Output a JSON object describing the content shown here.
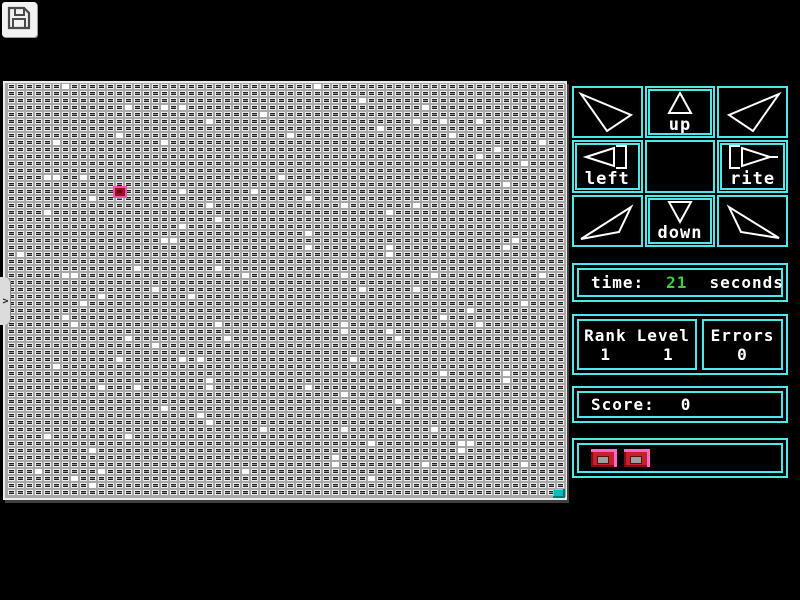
{
  "toolbar": {
    "save_icon": "floppy-disk"
  },
  "sidebar_tab": {
    "chevron": ">"
  },
  "board": {
    "cols": 62,
    "rows": 59,
    "cell_w": 9,
    "cell_h": 7,
    "colors": {
      "background": "#a8a8a8",
      "cell_border": "#ededed",
      "cell_dark": "#1f1f1f",
      "cell_band": "#8f8f8f",
      "white_cell": "#ffffff",
      "player_red": "#9c1020",
      "player_pink": "#f24fa6",
      "goal_teal": "#00bcbc"
    },
    "player_cell": {
      "col": 12,
      "row": 15
    },
    "goal_cell": {
      "col": 61,
      "row": 58
    },
    "white_cells": [
      [
        6,
        0
      ],
      [
        13,
        3
      ],
      [
        17,
        3
      ],
      [
        19,
        3
      ],
      [
        28,
        4
      ],
      [
        22,
        5
      ],
      [
        12,
        7
      ],
      [
        17,
        8
      ],
      [
        5,
        8
      ],
      [
        4,
        13
      ],
      [
        5,
        13
      ],
      [
        8,
        13
      ],
      [
        30,
        13
      ],
      [
        19,
        15
      ],
      [
        27,
        15
      ],
      [
        9,
        16
      ],
      [
        4,
        18
      ],
      [
        22,
        17
      ],
      [
        23,
        19
      ],
      [
        19,
        20
      ],
      [
        17,
        22
      ],
      [
        18,
        22
      ],
      [
        1,
        24
      ],
      [
        14,
        26
      ],
      [
        6,
        27
      ],
      [
        7,
        27
      ],
      [
        23,
        26
      ],
      [
        26,
        27
      ],
      [
        16,
        29
      ],
      [
        34,
        0
      ],
      [
        39,
        2
      ],
      [
        46,
        3
      ],
      [
        45,
        5
      ],
      [
        48,
        5
      ],
      [
        52,
        5
      ],
      [
        41,
        6
      ],
      [
        31,
        7
      ],
      [
        49,
        7
      ],
      [
        59,
        8
      ],
      [
        54,
        9
      ],
      [
        52,
        10
      ],
      [
        57,
        11
      ],
      [
        55,
        14
      ],
      [
        33,
        16
      ],
      [
        37,
        17
      ],
      [
        45,
        17
      ],
      [
        42,
        18
      ],
      [
        33,
        21
      ],
      [
        56,
        22
      ],
      [
        33,
        23
      ],
      [
        42,
        23
      ],
      [
        42,
        24
      ],
      [
        55,
        23
      ],
      [
        37,
        27
      ],
      [
        47,
        27
      ],
      [
        59,
        27
      ],
      [
        39,
        29
      ],
      [
        45,
        29
      ],
      [
        8,
        31
      ],
      [
        10,
        30
      ],
      [
        20,
        30
      ],
      [
        6,
        33
      ],
      [
        7,
        34
      ],
      [
        23,
        34
      ],
      [
        13,
        36
      ],
      [
        24,
        36
      ],
      [
        16,
        37
      ],
      [
        12,
        39
      ],
      [
        19,
        39
      ],
      [
        21,
        39
      ],
      [
        5,
        40
      ],
      [
        22,
        42
      ],
      [
        10,
        43
      ],
      [
        14,
        43
      ],
      [
        22,
        43
      ],
      [
        17,
        46
      ],
      [
        21,
        47
      ],
      [
        22,
        48
      ],
      [
        28,
        49
      ],
      [
        4,
        50
      ],
      [
        13,
        50
      ],
      [
        9,
        52
      ],
      [
        3,
        55
      ],
      [
        10,
        55
      ],
      [
        26,
        55
      ],
      [
        7,
        56
      ],
      [
        9,
        57
      ],
      [
        57,
        31
      ],
      [
        51,
        32
      ],
      [
        48,
        33
      ],
      [
        52,
        34
      ],
      [
        37,
        34
      ],
      [
        37,
        35
      ],
      [
        42,
        35
      ],
      [
        43,
        36
      ],
      [
        38,
        39
      ],
      [
        48,
        41
      ],
      [
        55,
        41
      ],
      [
        55,
        42
      ],
      [
        33,
        43
      ],
      [
        37,
        44
      ],
      [
        43,
        45
      ],
      [
        47,
        49
      ],
      [
        37,
        49
      ],
      [
        40,
        51
      ],
      [
        50,
        51
      ],
      [
        51,
        51
      ],
      [
        50,
        52
      ],
      [
        36,
        53
      ],
      [
        36,
        54
      ],
      [
        46,
        54
      ],
      [
        57,
        54
      ],
      [
        40,
        56
      ]
    ]
  },
  "dpad": {
    "labels": {
      "up": "up",
      "left": "left",
      "rite": "rite",
      "down": "down"
    },
    "diagonals": [
      "up-left",
      "up-right",
      "down-left",
      "down-right"
    ]
  },
  "time_panel": {
    "label": "time:",
    "value": "21",
    "unit": "seconds",
    "value_color": "#3ecf3e"
  },
  "stats": {
    "rank_label": "Rank",
    "rank_value": "1",
    "level_label": "Level",
    "level_value": "1",
    "errors_label": "Errors",
    "errors_value": "0"
  },
  "score_panel": {
    "label": "Score:",
    "value": "0"
  },
  "buttons_panel": {
    "button_count": 2
  },
  "colors": {
    "accent_cyan": "#4fe8e8",
    "button_red": "#c6202c",
    "button_pink": "#ff66cc"
  }
}
